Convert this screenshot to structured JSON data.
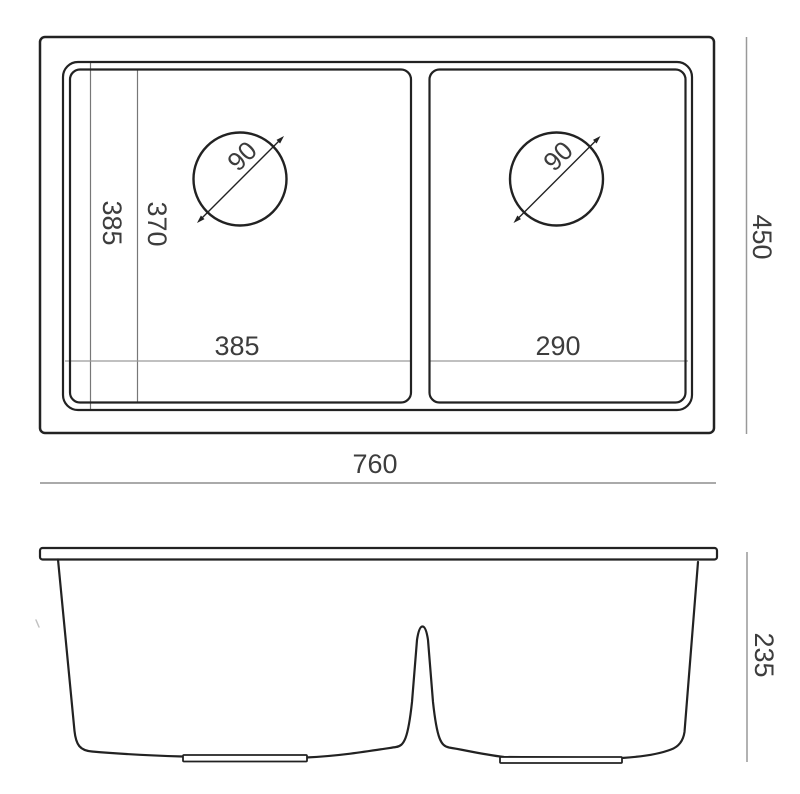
{
  "drawing": {
    "kind": "technical-drawing",
    "subject": "double-bowl-sink",
    "colors": {
      "background": "#ffffff",
      "main_line": "#222222",
      "dim_line": "#999999",
      "inner_dim_line": "#777777",
      "text": "#3d3d3d"
    },
    "top_view": {
      "dims": {
        "overall_width": "760",
        "overall_depth": "450",
        "left_bowl_width": "385",
        "right_bowl_width": "290",
        "bowl_length_outer": "385",
        "bowl_length_inner": "370",
        "left_drain_diameter": "90",
        "right_drain_diameter": "90"
      }
    },
    "side_view": {
      "dims": {
        "overall_height": "235"
      }
    }
  }
}
